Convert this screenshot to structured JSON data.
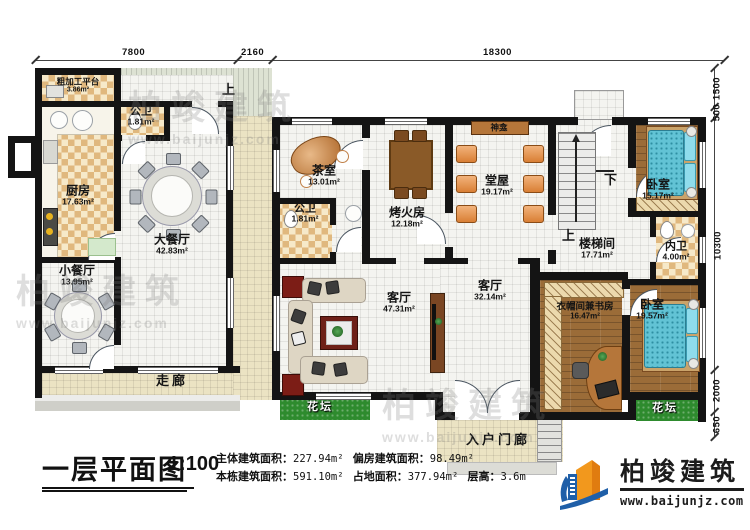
{
  "dims": {
    "top": [
      "7800",
      "2160",
      "18300"
    ],
    "right": [
      "1500",
      "500",
      "10300",
      "2000",
      "650"
    ]
  },
  "rooms": {
    "rough_platform": {
      "name": "粗加工平台",
      "area": "3.86m²"
    },
    "public_wc_1": {
      "name": "公卫",
      "area": "1.81m²"
    },
    "kitchen": {
      "name": "厨房",
      "area": "17.63m²"
    },
    "big_dining": {
      "name": "大餐厅",
      "area": "42.83m²"
    },
    "small_dining": {
      "name": "小餐厅",
      "area": "13.95m²"
    },
    "corridor": {
      "name": "走廊"
    },
    "tea_room": {
      "name": "茶室",
      "area": "13.01m²"
    },
    "public_wc_2": {
      "name": "公卫",
      "area": "1.81m²"
    },
    "fire_room": {
      "name": "烤火房",
      "area": "12.18m²"
    },
    "hall": {
      "name": "堂屋",
      "area": "19.17m²"
    },
    "shrine": {
      "name": "神龛"
    },
    "bedroom_1": {
      "name": "卧室",
      "area": "15.17m²"
    },
    "inner_wc": {
      "name": "内卫",
      "area": "4.00m²"
    },
    "stair_room": {
      "name": "楼梯间",
      "area": "17.71m²"
    },
    "living_1": {
      "name": "客厅",
      "area": "47.31m²"
    },
    "living_2": {
      "name": "客厅",
      "area": "32.14m²"
    },
    "cloak_study": {
      "name": "衣帽间兼书房",
      "area": "16.47m²"
    },
    "bedroom_2": {
      "name": "卧室",
      "area": "19.57m²"
    },
    "flowerbed_left": {
      "name": "花坛"
    },
    "flowerbed_right": {
      "name": "花坛"
    },
    "entry_porch": {
      "name": "入户门廊"
    }
  },
  "stairs": {
    "up": "上",
    "down": "下",
    "up_outdoor": "上"
  },
  "footer": {
    "title": "一层平面图",
    "scale": "1:100",
    "stats": [
      {
        "label": "主体建筑面积：",
        "value": "227.94m²"
      },
      {
        "label": "偏房建筑面积：",
        "value": "98.49m²"
      },
      {
        "label": "本栋建筑面积：",
        "value": "591.10m²"
      },
      {
        "label": "占地面积：",
        "value": "377.94m²"
      },
      {
        "label": "层高：",
        "value": "3.6m"
      }
    ]
  },
  "logo": {
    "name": "柏竣建筑",
    "site": "www.baijunjz.com"
  },
  "watermark": {
    "name": "柏竣建筑",
    "site": "www.baijunjz.com"
  }
}
